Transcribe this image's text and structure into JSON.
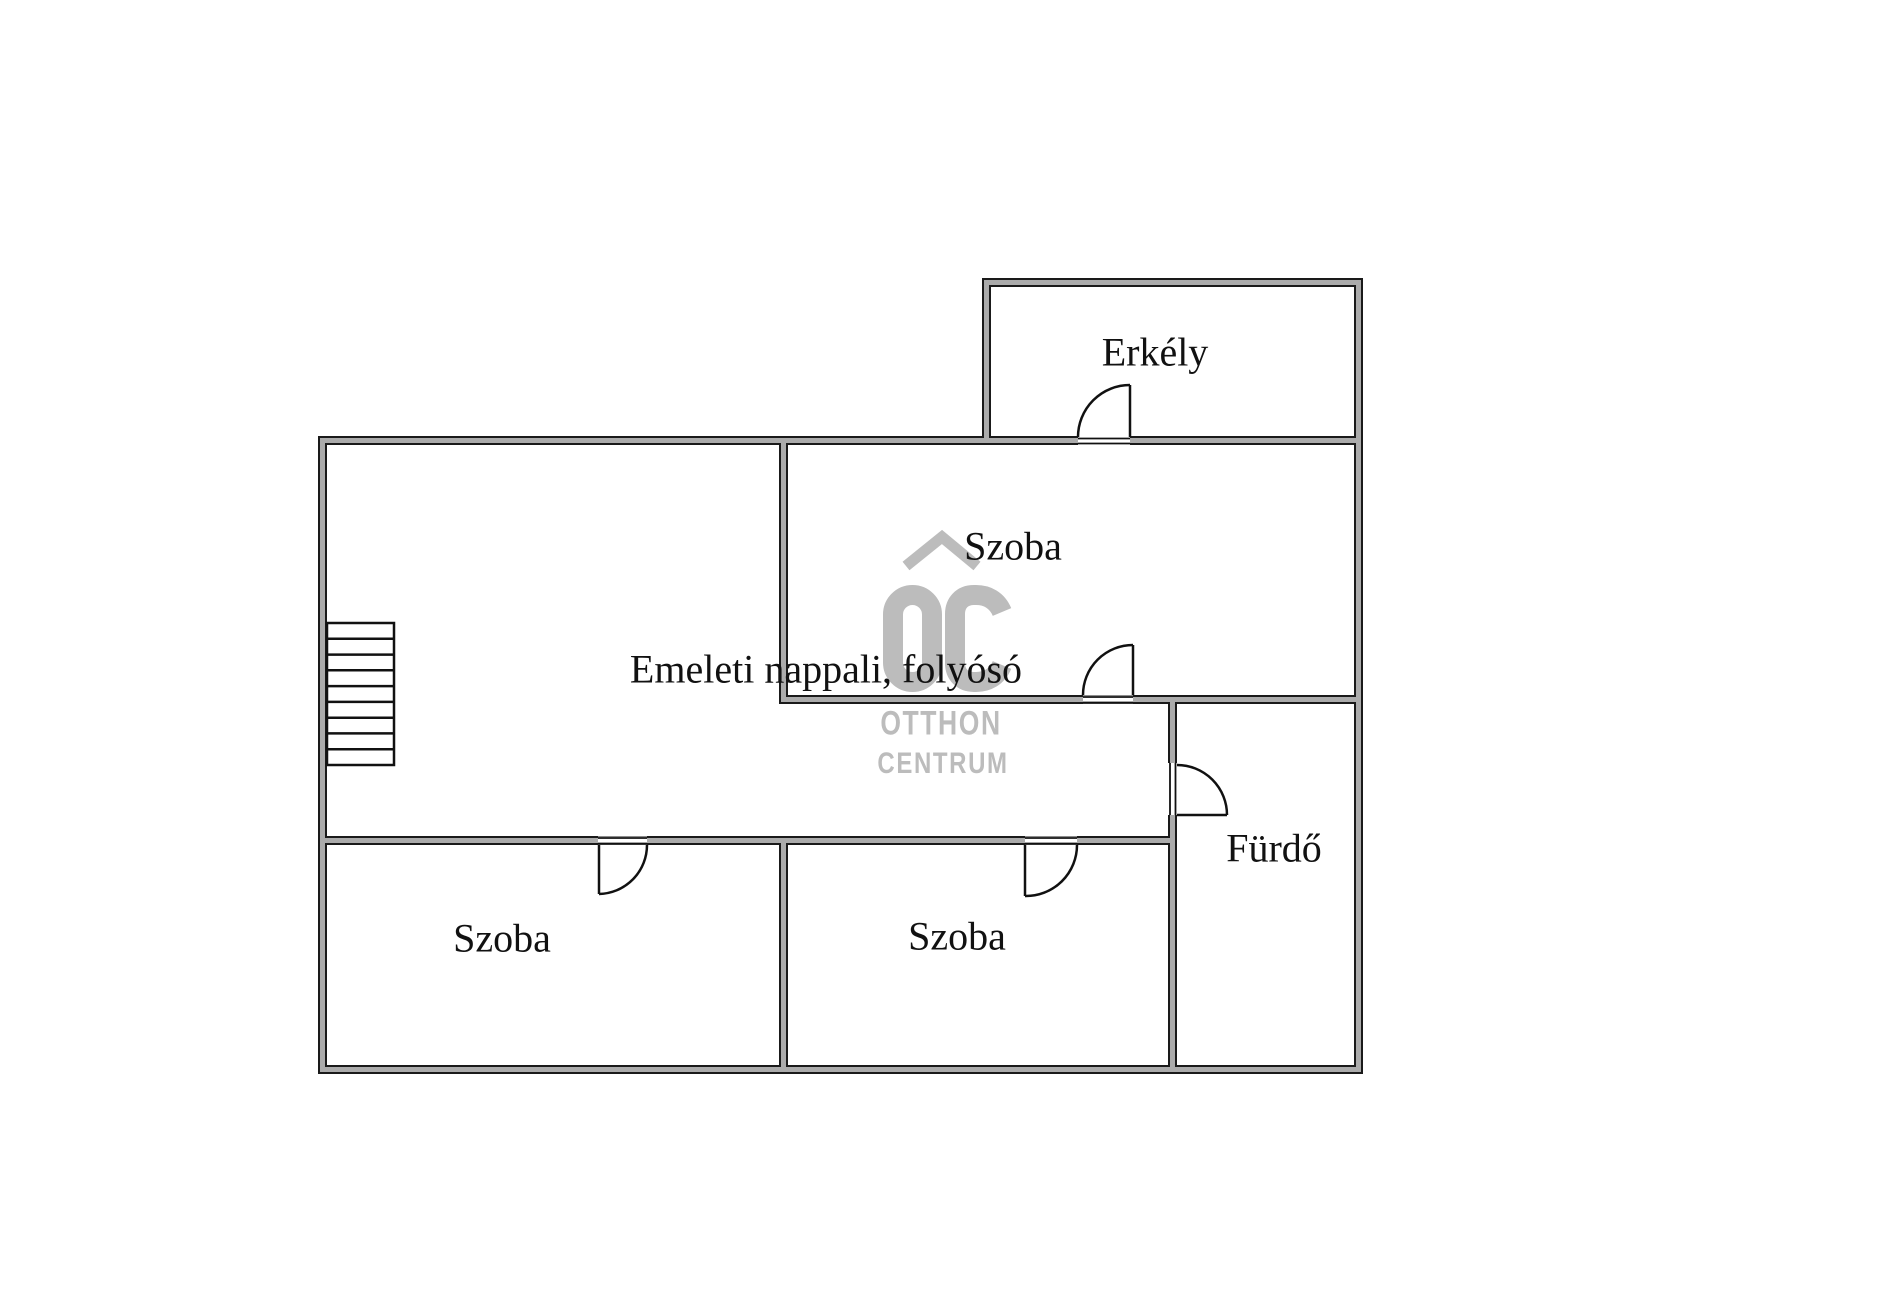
{
  "colors": {
    "background": "#ffffff",
    "wall_fill": "#ababab",
    "wall_outline": "#1a1a1a",
    "door_line": "#111111",
    "label_text": "#111111",
    "watermark_gray": "#bcbcbc"
  },
  "rooms": {
    "balcony": {
      "label": "Erkély"
    },
    "living": {
      "label": "Emeleti nappali, folyósó"
    },
    "bedroom_top": {
      "label": "Szoba"
    },
    "bathroom": {
      "label": "Fürdő"
    },
    "bedroom_left": {
      "label": "Szoba"
    },
    "bedroom_middle": {
      "label": "Szoba"
    }
  },
  "watermark": {
    "monogram": "OC",
    "brand_line1": "OTTHON",
    "brand_line2": "CENTRUM"
  }
}
